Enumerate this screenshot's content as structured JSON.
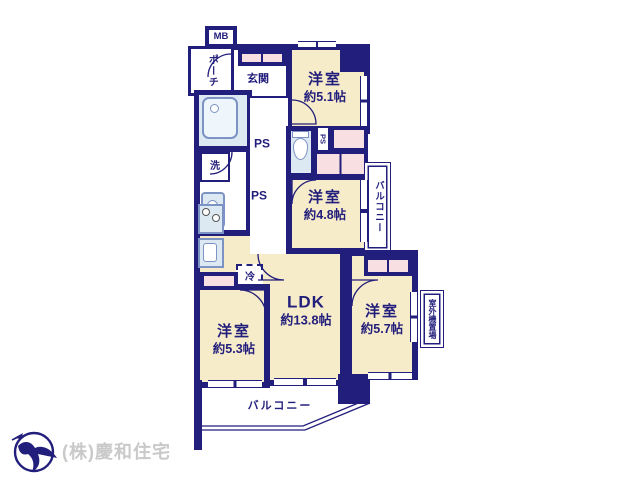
{
  "colors": {
    "wall_navy": "#221e7b",
    "room_cream": "#f7ecca",
    "closet_pink": "#f8dfe2",
    "wet_blue": "#dce9f3",
    "company_gray": "#c9c9c9"
  },
  "floorplan": {
    "mb_label": "MB",
    "porch_label": "ポーチ",
    "entrance_label": "玄関",
    "wash_label": "洗",
    "ps_label_1": "PS",
    "ps_label_2": "PS",
    "ps_label_3": "PS",
    "fridge_label": "冷",
    "side_balcony_label": "バルコニー",
    "bottom_balcony_label": "バルコニー",
    "outdoor_unit_label": "室外機置場",
    "rooms": [
      {
        "id": "bedroom-51",
        "name": "洋室",
        "size": "約5.1帖"
      },
      {
        "id": "bedroom-48",
        "name": "洋室",
        "size": "約4.8帖"
      },
      {
        "id": "ldk",
        "name": "LDK",
        "size": "約13.8帖"
      },
      {
        "id": "bedroom-53",
        "name": "洋室",
        "size": "約5.3帖"
      },
      {
        "id": "bedroom-57",
        "name": "洋室",
        "size": "約5.7帖"
      }
    ]
  },
  "footer": {
    "company_name": "(株)慶和住宅"
  }
}
